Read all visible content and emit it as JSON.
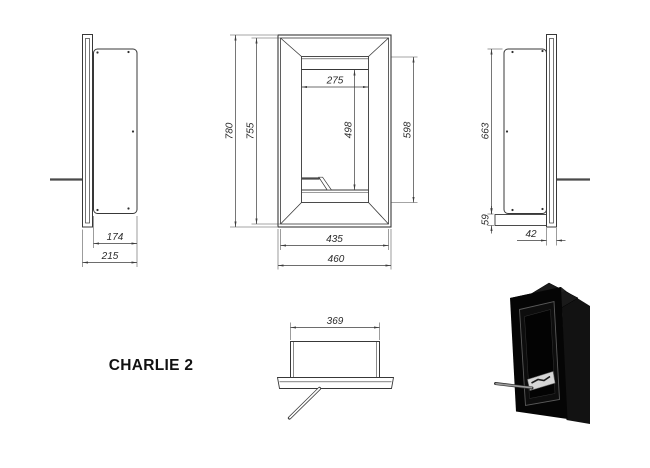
{
  "title": "CHARLIE 2",
  "dimensions": {
    "side_left": {
      "inner_depth": "174",
      "overall_depth": "215"
    },
    "front": {
      "overall_height": "780",
      "frame_height": "755",
      "opening_width": "275",
      "chamber_height": "498",
      "opening_height": "598",
      "frame_width": "435",
      "overall_width": "460"
    },
    "side_right": {
      "body_height": "663",
      "bottom_offset": "59",
      "frame_depth": "42"
    },
    "top": {
      "body_width": "369"
    }
  },
  "colors": {
    "line": "#3c3c3c",
    "dimension_text": "#2b2b2b",
    "title_text": "#111111",
    "product_black": "#0a0a0a",
    "burner_steel": "#d6d6d6",
    "background": "#ffffff"
  }
}
